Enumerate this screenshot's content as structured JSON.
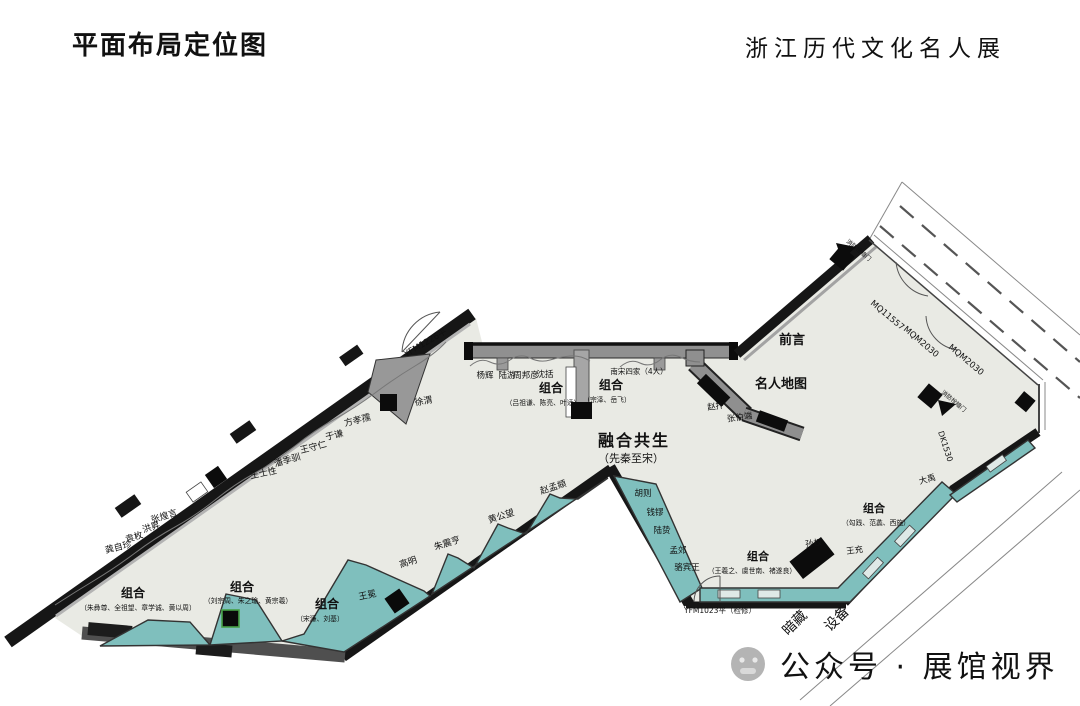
{
  "header": {
    "title_left": "平面布局定位图",
    "title_right": "浙江历代文化名人展"
  },
  "zones": {
    "center_title": "融合共生",
    "center_sub": "（先秦至宋）",
    "foreword": "前言",
    "celebrity_map": "名人地图"
  },
  "people": {
    "xuwei": "徐渭",
    "fangxiaoru": "方孝孺",
    "yuqian": "于谦",
    "wangshouren": "王守仁",
    "panjixun": "潘季驯",
    "wangshixing": "王士性",
    "zhanghuangyan": "张煌言",
    "hongsheng": "洪昇",
    "yuanmei": "袁枚",
    "gongzizhen": "龚自珍",
    "wangmian": "王冕",
    "gaoming": "高明",
    "zhuzhenheng": "朱震亨",
    "huanggongwang": "黄公望",
    "zhaomengfu": "赵孟頫",
    "yanghui": "杨辉",
    "luyou": "陆游",
    "zhoubangyan": "周邦彦",
    "shenkuo": "沈括",
    "nansongsijia": "南宋四家（4人）",
    "zhaobian": "赵抃",
    "zhangboduan": "张伯端",
    "huze": "胡则",
    "qianliu": "钱镠",
    "luzhi": "陆贽",
    "mengjiao": "孟郊",
    "luobinwang": "骆宾王",
    "sunquan": "孙权",
    "wangchong": "王充",
    "dayu": "大禹"
  },
  "groups": {
    "mingqing1": {
      "label": "组合",
      "names": "（朱彝尊、全祖望、章学诚、黄以周）"
    },
    "mingqing2": {
      "label": "组合",
      "names": "（刘宗周、朱之瑜、黄宗羲）"
    },
    "mingqing3": {
      "label": "组合",
      "names": "（宋濂、刘基）"
    },
    "song1": {
      "label": "组合",
      "names": "（吕祖谦、陈亮、叶适）"
    },
    "song2": {
      "label": "组合",
      "names": "（宗泽、岳飞）"
    },
    "jin": {
      "label": "组合",
      "names": "（王羲之、虞世南、褚遂良）"
    },
    "xianqin": {
      "label": "组合",
      "names": "（勾践、范蠡、西施）"
    }
  },
  "annotations": {
    "door_top": "YFM1226平",
    "door_bottom": "YFM1023平（检修）",
    "wall_code_1": "MQ11557",
    "wall_code_2": "MQM2030",
    "wall_code_3": "MQM2030",
    "right_code": "DK1530",
    "fire_hydrant_1": "消防栓暗门",
    "fire_hydrant_2": "消防栓暗门",
    "hidden_1": "暗藏",
    "hidden_2": "设备"
  },
  "watermark": {
    "text": "公众号 · 展馆视界"
  },
  "colors": {
    "exhibit_teal": "#7fbfbd",
    "wall_black": "#161616",
    "floor": "#e9eae4",
    "partition_gray": "#9a9a9a"
  }
}
